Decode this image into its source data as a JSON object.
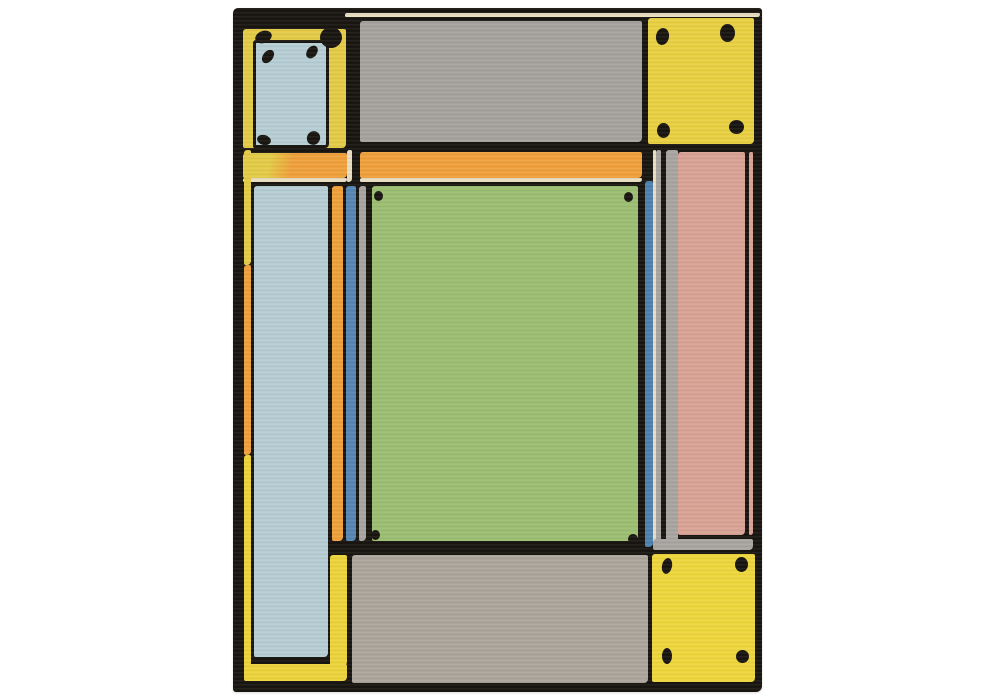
{
  "scene": {
    "description": "Hand-tufted wool area rug photographed flat on a white background: a Frank Lloyd Wright style geometric composition of yellow corner blocks with black rivet dots, a large sage-green center field, gray panels top and bottom, a dusty-pink side panel, a pale-blue column and orange, blue and gray pinstripes, all outlined with thick hand-drawn black lines and thin cream trim.",
    "background": "#ffffff"
  },
  "palette": {
    "outline": "#191511",
    "yellow_tl": "#e4cc48",
    "yellow_tr": "#e9d143",
    "yellow_br": "#eed73e",
    "yellow_frame": "#edd43c",
    "light_blue": "#b7ced5",
    "gray_top": "#a6a29d",
    "gray_bottom": "#ada69d",
    "gray_strip": "#a9a5a3",
    "orange": "#f0a13c",
    "green": "#9dbf73",
    "blue": "#5787b4",
    "blue_right": "#4e82b0",
    "pink": "#d9a395",
    "cream": "#e9dec1"
  },
  "rug": {
    "x": 233,
    "y": 8,
    "width": 529,
    "height": 684,
    "panels": [
      {
        "name": "top-cream-trim",
        "color": "cream",
        "x": 112,
        "y": 5,
        "w": 415,
        "h": 4
      },
      {
        "name": "top-left-yellow-block",
        "color": "yellow_tl",
        "x": 10,
        "y": 21,
        "w": 103,
        "h": 119
      },
      {
        "name": "top-left-blue-plate",
        "color": "light_blue",
        "x": 20,
        "y": 32,
        "w": 76,
        "h": 108,
        "border": 3
      },
      {
        "name": "top-gray-panel",
        "color": "gray_top",
        "x": 127,
        "y": 13,
        "w": 282,
        "h": 121
      },
      {
        "name": "top-right-yellow-block",
        "color": "yellow_tr",
        "x": 415,
        "y": 10,
        "w": 106,
        "h": 126
      },
      {
        "name": "left-transom-band",
        "gradient": {
          "angle": 102,
          "stops": [
            [
              "yellow_tl",
              26
            ],
            [
              "orange",
              47
            ]
          ]
        },
        "x": 10,
        "y": 145,
        "w": 104,
        "h": 25
      },
      {
        "name": "band-cream-divider",
        "color": "cream",
        "x": 114,
        "y": 142,
        "w": 5,
        "h": 32
      },
      {
        "name": "right-transom-band",
        "color": "orange",
        "x": 127,
        "y": 144,
        "w": 282,
        "h": 26
      },
      {
        "name": "band-cream-underline-left",
        "color": "cream",
        "x": 10,
        "y": 170,
        "w": 104,
        "h": 4
      },
      {
        "name": "band-cream-underline-right",
        "color": "cream",
        "x": 127,
        "y": 170,
        "w": 282,
        "h": 4
      },
      {
        "name": "left-edge-strip-upper",
        "color": "yellow_tl",
        "x": 11,
        "y": 142,
        "w": 7,
        "h": 115
      },
      {
        "name": "left-edge-strip-middle",
        "color": "orange",
        "x": 11,
        "y": 257,
        "w": 7,
        "h": 190
      },
      {
        "name": "left-edge-strip-lower",
        "color": "yellow_frame",
        "x": 11,
        "y": 447,
        "w": 7,
        "h": 212
      },
      {
        "name": "light-blue-column",
        "color": "light_blue",
        "x": 21,
        "y": 178,
        "w": 74,
        "h": 471
      },
      {
        "name": "orange-stripe",
        "color": "orange",
        "x": 99,
        "y": 178,
        "w": 11,
        "h": 355
      },
      {
        "name": "blue-stripe",
        "color": "blue",
        "x": 113,
        "y": 178,
        "w": 10,
        "h": 355
      },
      {
        "name": "gray-stripe",
        "color": "gray_strip",
        "x": 126,
        "y": 178,
        "w": 7,
        "h": 355
      },
      {
        "name": "green-field-panel",
        "color": "green",
        "x": 139,
        "y": 178,
        "w": 266,
        "h": 355
      },
      {
        "name": "right-blue-stripe",
        "color": "blue_right",
        "x": 412,
        "y": 173,
        "w": 8,
        "h": 366
      },
      {
        "name": "right-cream-sliver",
        "color": "cream",
        "x": 420,
        "y": 142,
        "w": 3,
        "h": 398
      },
      {
        "name": "right-gray-sliver-inner",
        "color": "gray_strip",
        "x": 423,
        "y": 142,
        "w": 5,
        "h": 398
      },
      {
        "name": "right-gray-sliver-outer",
        "color": "gray_strip",
        "x": 433,
        "y": 142,
        "w": 12,
        "h": 398
      },
      {
        "name": "pink-panel",
        "color": "pink",
        "x": 445,
        "y": 144,
        "w": 67,
        "h": 383
      },
      {
        "name": "pink-edge-sliver",
        "color": "pink",
        "x": 516,
        "y": 144,
        "w": 4,
        "h": 383
      },
      {
        "name": "under-pink-gray-strip",
        "color": "gray_strip",
        "x": 420,
        "y": 531,
        "w": 100,
        "h": 11
      },
      {
        "name": "bottom-gray-panel",
        "color": "gray_bottom",
        "x": 119,
        "y": 547,
        "w": 296,
        "h": 128
      },
      {
        "name": "bottom-right-yellow-block",
        "color": "yellow_br",
        "x": 419,
        "y": 546,
        "w": 103,
        "h": 128
      },
      {
        "name": "frame-right-yellow-bar",
        "color": "yellow_frame",
        "x": 97,
        "y": 547,
        "w": 17,
        "h": 111
      },
      {
        "name": "frame-bottom-yellow-bar",
        "color": "yellow_frame",
        "x": 11,
        "y": 656,
        "w": 103,
        "h": 17
      }
    ],
    "dots": [
      {
        "x": 87,
        "y": 19,
        "w": 22,
        "h": 21,
        "rot": 0
      },
      {
        "x": 22,
        "y": 23,
        "w": 17,
        "h": 12,
        "rot": -20
      },
      {
        "x": 30,
        "y": 41,
        "w": 10,
        "h": 15,
        "rot": 38
      },
      {
        "x": 74,
        "y": 37,
        "w": 10,
        "h": 14,
        "rot": 38
      },
      {
        "x": 24,
        "y": 127,
        "w": 14,
        "h": 10,
        "rot": 15
      },
      {
        "x": 74,
        "y": 123,
        "w": 13,
        "h": 14,
        "rot": 30
      },
      {
        "x": 423,
        "y": 20,
        "w": 13,
        "h": 17,
        "rot": 10
      },
      {
        "x": 487,
        "y": 16,
        "w": 15,
        "h": 18,
        "rot": 0
      },
      {
        "x": 424,
        "y": 115,
        "w": 13,
        "h": 15,
        "rot": 0
      },
      {
        "x": 496,
        "y": 112,
        "w": 15,
        "h": 14,
        "rot": 0
      },
      {
        "x": 141,
        "y": 183,
        "w": 9,
        "h": 10,
        "rot": 0
      },
      {
        "x": 391,
        "y": 184,
        "w": 9,
        "h": 10,
        "rot": 0
      },
      {
        "x": 138,
        "y": 522,
        "w": 9,
        "h": 10,
        "rot": 0
      },
      {
        "x": 395,
        "y": 526,
        "w": 10,
        "h": 10,
        "rot": 0
      },
      {
        "x": 429,
        "y": 550,
        "w": 10,
        "h": 16,
        "rot": 12
      },
      {
        "x": 502,
        "y": 549,
        "w": 13,
        "h": 15,
        "rot": 0
      },
      {
        "x": 429,
        "y": 640,
        "w": 10,
        "h": 16,
        "rot": 0
      },
      {
        "x": 503,
        "y": 642,
        "w": 13,
        "h": 13,
        "rot": 0
      }
    ]
  }
}
